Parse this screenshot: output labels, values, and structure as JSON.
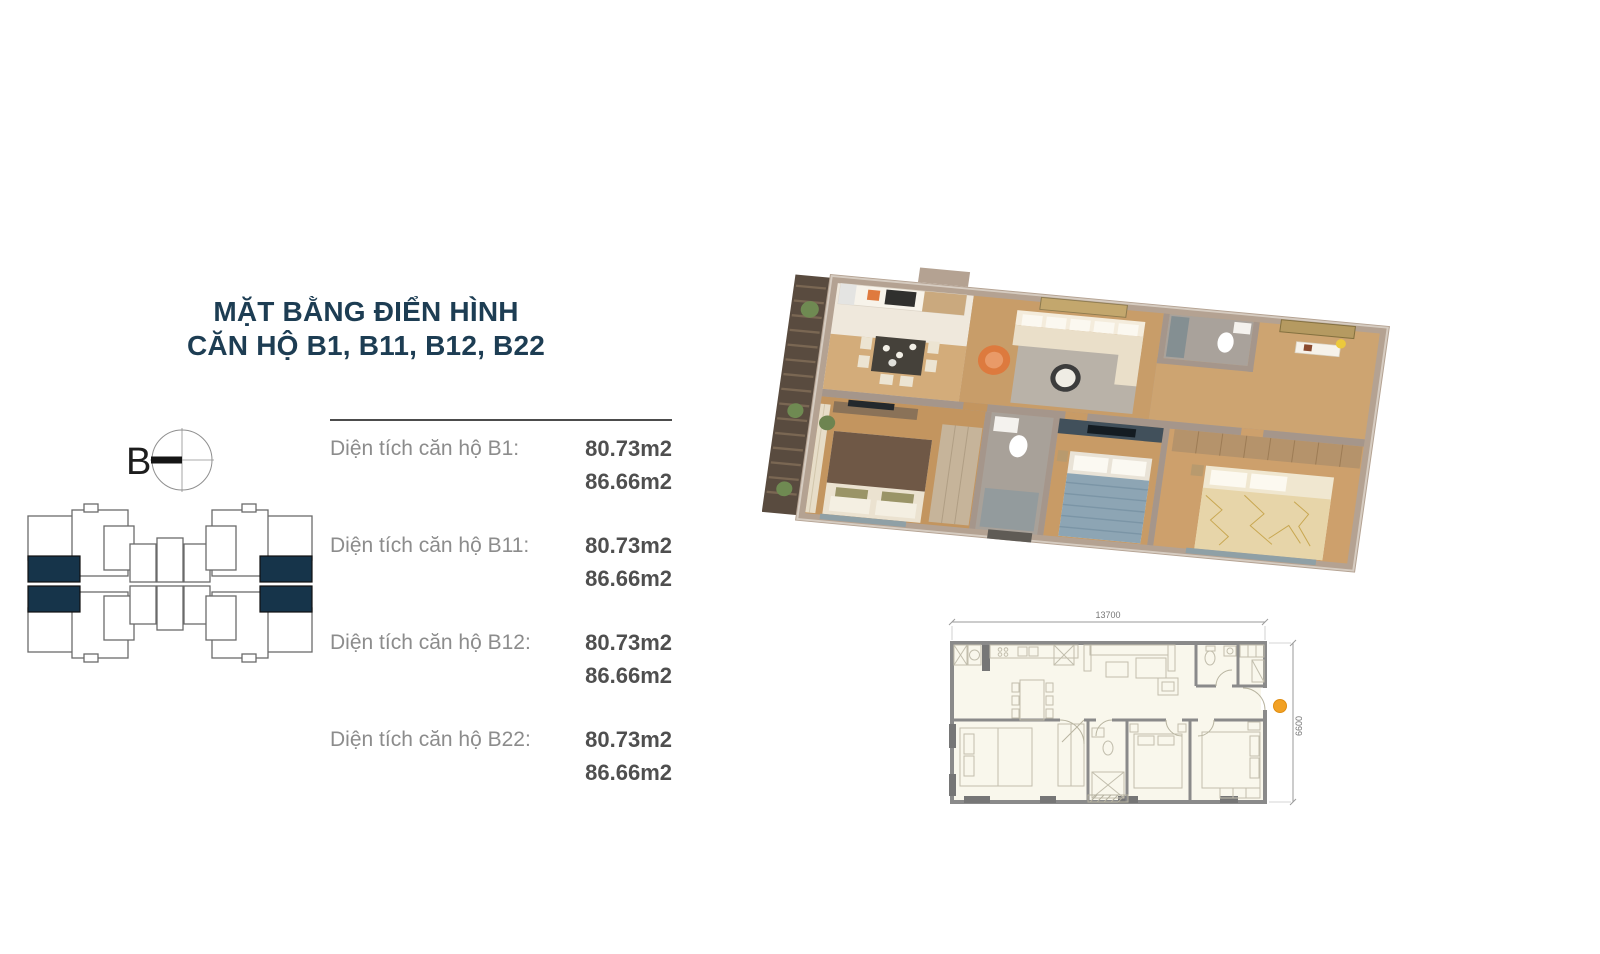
{
  "title": {
    "line1": "MẶT BẰNG ĐIỂN HÌNH",
    "line2": "CĂN HỘ B1, B11, B12, B22"
  },
  "section_marker": {
    "label": "B"
  },
  "area_table": {
    "rows": [
      {
        "label": "Diện tích căn hộ B1:",
        "area_main": "80.73m2",
        "area_gross": "86.66m2"
      },
      {
        "label": "Diện tích căn hộ B11:",
        "area_main": "80.73m2",
        "area_gross": "86.66m2"
      },
      {
        "label": "Diện tích căn hộ B12:",
        "area_main": "80.73m2",
        "area_gross": "86.66m2"
      },
      {
        "label": "Diện tích căn hộ B22:",
        "area_main": "80.73m2",
        "area_gross": "86.66m2"
      }
    ]
  },
  "floor_plan_2d": {
    "width_dim": "13700",
    "height_dim": "6600"
  },
  "colors": {
    "title_navy": "#1d3d53",
    "unit_highlight_navy": "#16344a",
    "label_gray": "#8c8c8c",
    "value_gray": "#4f4f4f",
    "entry_marker_orange": "#f2a124",
    "wall_taupe": "#a5968b",
    "wood_floor": "#c89d69"
  }
}
